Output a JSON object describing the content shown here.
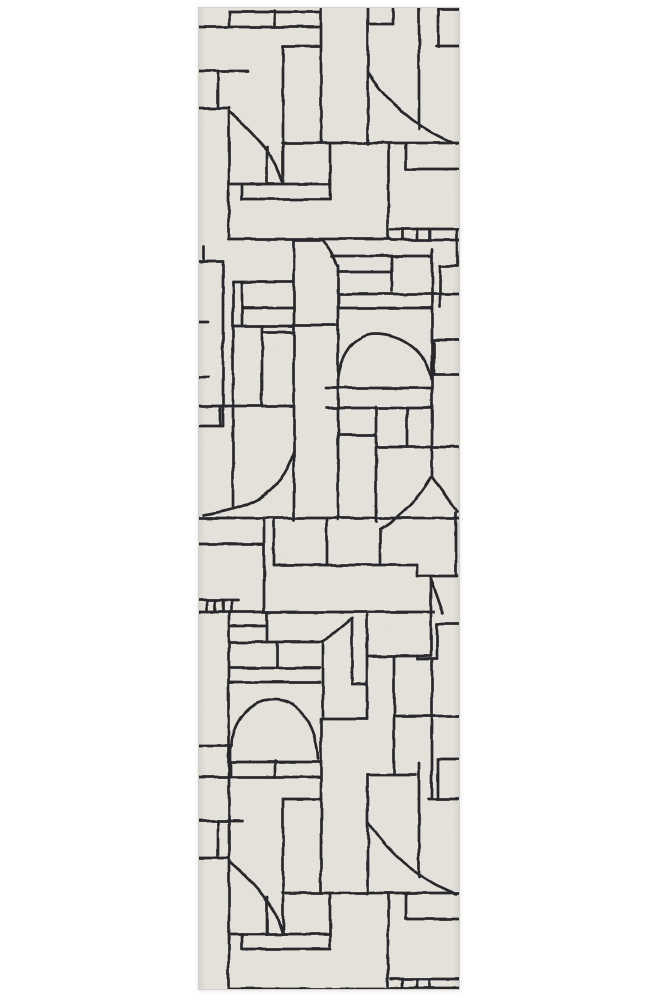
{
  "page": {
    "background_color": "#ffffff"
  },
  "rug": {
    "field_color": "#e5e2dc",
    "edge_color": "#d3d0ca",
    "line_color": "#232327",
    "x": 198,
    "y": 7,
    "width": 262,
    "height": 983,
    "strokes": [
      "M31 5H122",
      "M0 20H122",
      "M31 5V20",
      "M77 4V20",
      "M123 0V136",
      "M170 0V137",
      "M170 17H195",
      "M195 0V17",
      "M221 0V122",
      "M240 2V39",
      "M240 2H262",
      "M238 39H262",
      "M0 64H50",
      "M20 64V101",
      "M0 101H31",
      "M31 101V232",
      "M31 104C55 125 70 143 78 158L85 177",
      "M69 140V177",
      "M85 39V177",
      "M85 39H123",
      "M84 136H262",
      "M170 65C180 80 192 94 206 106C221 119 238 129 258 137",
      "M208 137V162",
      "M208 162H262",
      "M190 137V231",
      "M31 177H132",
      "M132 136V192",
      "M44 177V192",
      "M44 192H132",
      "M31 232H192",
      "M193 222H262",
      "M204 222V233",
      "M219 222V233",
      "M232 222V233",
      "M193 233H262",
      "M96 233H125",
      "M96 233V513",
      "M125 234Q135 245 139 259",
      "M140 259V513",
      "M95 318H140",
      "M5 240V254",
      "M0 254H25",
      "M25 254V419",
      "M35 275H96",
      "M35 275V500",
      "M44 275V319",
      "M44 301H96",
      "M35 319H96",
      "M64 325H96",
      "M64 319V399",
      "M0 399H96",
      "M22 399V419",
      "M0 419H25",
      "M0 315H10",
      "M0 370H10",
      "M96 445C90 465 78 481 62 491C47 500 25 505 5 508",
      "M134 249H234",
      "M194 249V284",
      "M140 265H194",
      "M140 287H262",
      "M140 301H234",
      "M140 374C141 352 156 327 177 327C206 327 230 348 233 372",
      "M128 381H233",
      "M129 401H234",
      "M234 242V470",
      "M259 222V259",
      "M242 259H259",
      "M242 259V300",
      "M235 333H262",
      "M236 335V368",
      "M236 368H262",
      "M140 428H178",
      "M178 400V515",
      "M178 440H262",
      "M209 401V440",
      "M233 470C222 490 203 509 182 522",
      "M234 470Q248 490 260 504",
      "M182 522V557",
      "M0 511H262",
      "M66 513V605",
      "M76 513V558",
      "M76 558H219",
      "M129 513V558",
      "M0 537H66",
      "M0 593H40",
      "M9 593V605",
      "M17 593V605",
      "M25 593V605",
      "M33 593V605",
      "M0 605H236",
      "M31 605V982",
      "M32 619H69",
      "M69 605V635",
      "M31 635H125",
      "M79 635V661",
      "M31 661H122",
      "M31 675H122",
      "M125 635V712",
      "M125 635L154 611",
      "M154 611V677",
      "M154 677H169",
      "M169 607V712",
      "M125 712H169",
      "M169 649H232",
      "M196 649V768",
      "M219 558V569",
      "M219 569H259",
      "M258 505V569",
      "M233 569V649",
      "M233 572L245 606",
      "M239 617H262",
      "M239 617V652",
      "M220 652H239",
      "M220 649V652",
      "M196 709H262",
      "M234 652V792",
      "M34 739C34 716 52 692 77 692C102 692 119 722 120 752",
      "M0 739H34",
      "M33 739V770",
      "M123 712V886",
      "M31 755H122",
      "M0 770H122",
      "M77 754V770",
      "M170 768V887",
      "M170 768H218",
      "M221 756V870",
      "M240 752V792",
      "M240 752H262",
      "M230 792H262",
      "M0 814H45",
      "M20 814V851",
      "M0 851H31",
      "M31 854C55 875 70 893 78 908L85 927",
      "M69 890V927",
      "M85 792V927",
      "M85 792H123",
      "M84 886H262",
      "M170 815C180 830 192 844 206 856C221 869 238 879 258 887",
      "M208 887V912",
      "M208 912H262",
      "M190 887V981",
      "M31 927H132",
      "M132 886V942",
      "M44 927V942",
      "M44 942H132",
      "M31 982H192",
      "M193 972H262",
      "M204 972V981",
      "M219 972V981",
      "M232 972V981",
      "M193 981H262"
    ]
  }
}
